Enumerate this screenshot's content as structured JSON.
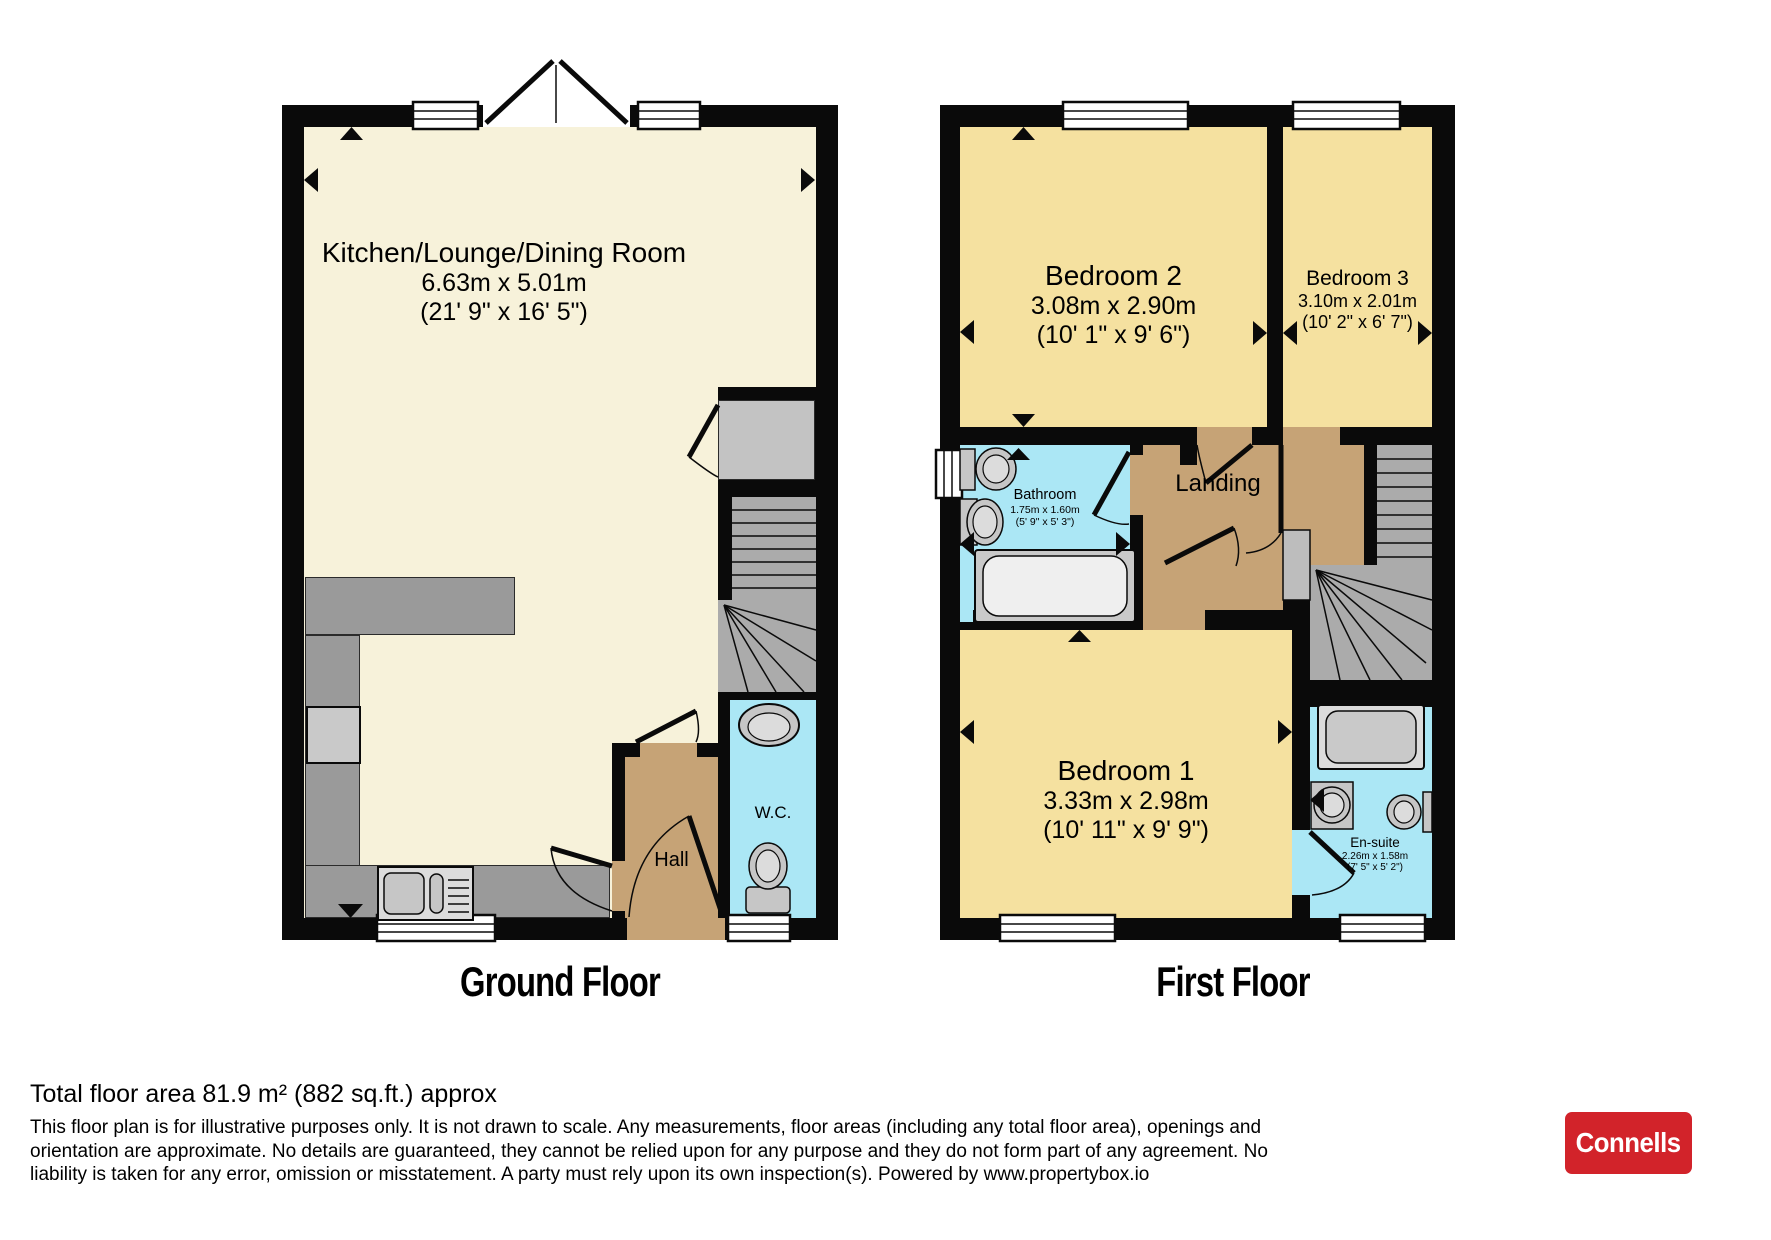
{
  "titles": {
    "ground": "Ground Floor",
    "first": "First Floor"
  },
  "rooms": {
    "kitchen": {
      "name": "Kitchen/Lounge/Dining Room",
      "metric": "6.63m x 5.01m",
      "imperial": "(21' 9\" x 16' 5\")"
    },
    "hall": {
      "name": "Hall"
    },
    "wc": {
      "name": "W.C."
    },
    "bedroom2": {
      "name": "Bedroom 2",
      "metric": "3.08m x 2.90m",
      "imperial": "(10' 1\" x 9' 6\")"
    },
    "bedroom3": {
      "name": "Bedroom 3",
      "metric": "3.10m x 2.01m",
      "imperial": "(10' 2\" x 6' 7\")"
    },
    "bathroom": {
      "name": "Bathroom",
      "metric": "1.75m x 1.60m",
      "imperial": "(5' 9\" x 5' 3\")"
    },
    "landing": {
      "name": "Landing"
    },
    "bedroom1": {
      "name": "Bedroom 1",
      "metric": "3.33m x 2.98m",
      "imperial": "(10' 11\" x 9' 9\")"
    },
    "ensuite": {
      "name": "En-suite",
      "metric": "2.26m x 1.58m",
      "imperial": "(7' 5\" x 5' 2\")"
    }
  },
  "footer": {
    "total_area": "Total floor area 81.9 m² (882 sq.ft.) approx",
    "disclaimer": "This floor plan is for illustrative purposes only. It is not drawn to scale. Any measurements, floor areas (including any total floor area), openings and orientation are approximate. No details are guaranteed, they cannot be relied upon for any purpose and they do not form part of any agreement. No liability is taken for any error, omission or misstatement. A party must rely upon its own inspection(s). Powered by www.propertybox.io",
    "brand": "Connells"
  },
  "colors": {
    "wall": "#0a0a0a",
    "living": "#f7f2da",
    "bedroom": "#f5e1a0",
    "wet": "#abe7f5",
    "hallway": "#c6a376",
    "counter": "#9a9a9a",
    "stairs": "#ababab",
    "fixture": "#c6c6c6",
    "brand_red": "#d2232a"
  }
}
